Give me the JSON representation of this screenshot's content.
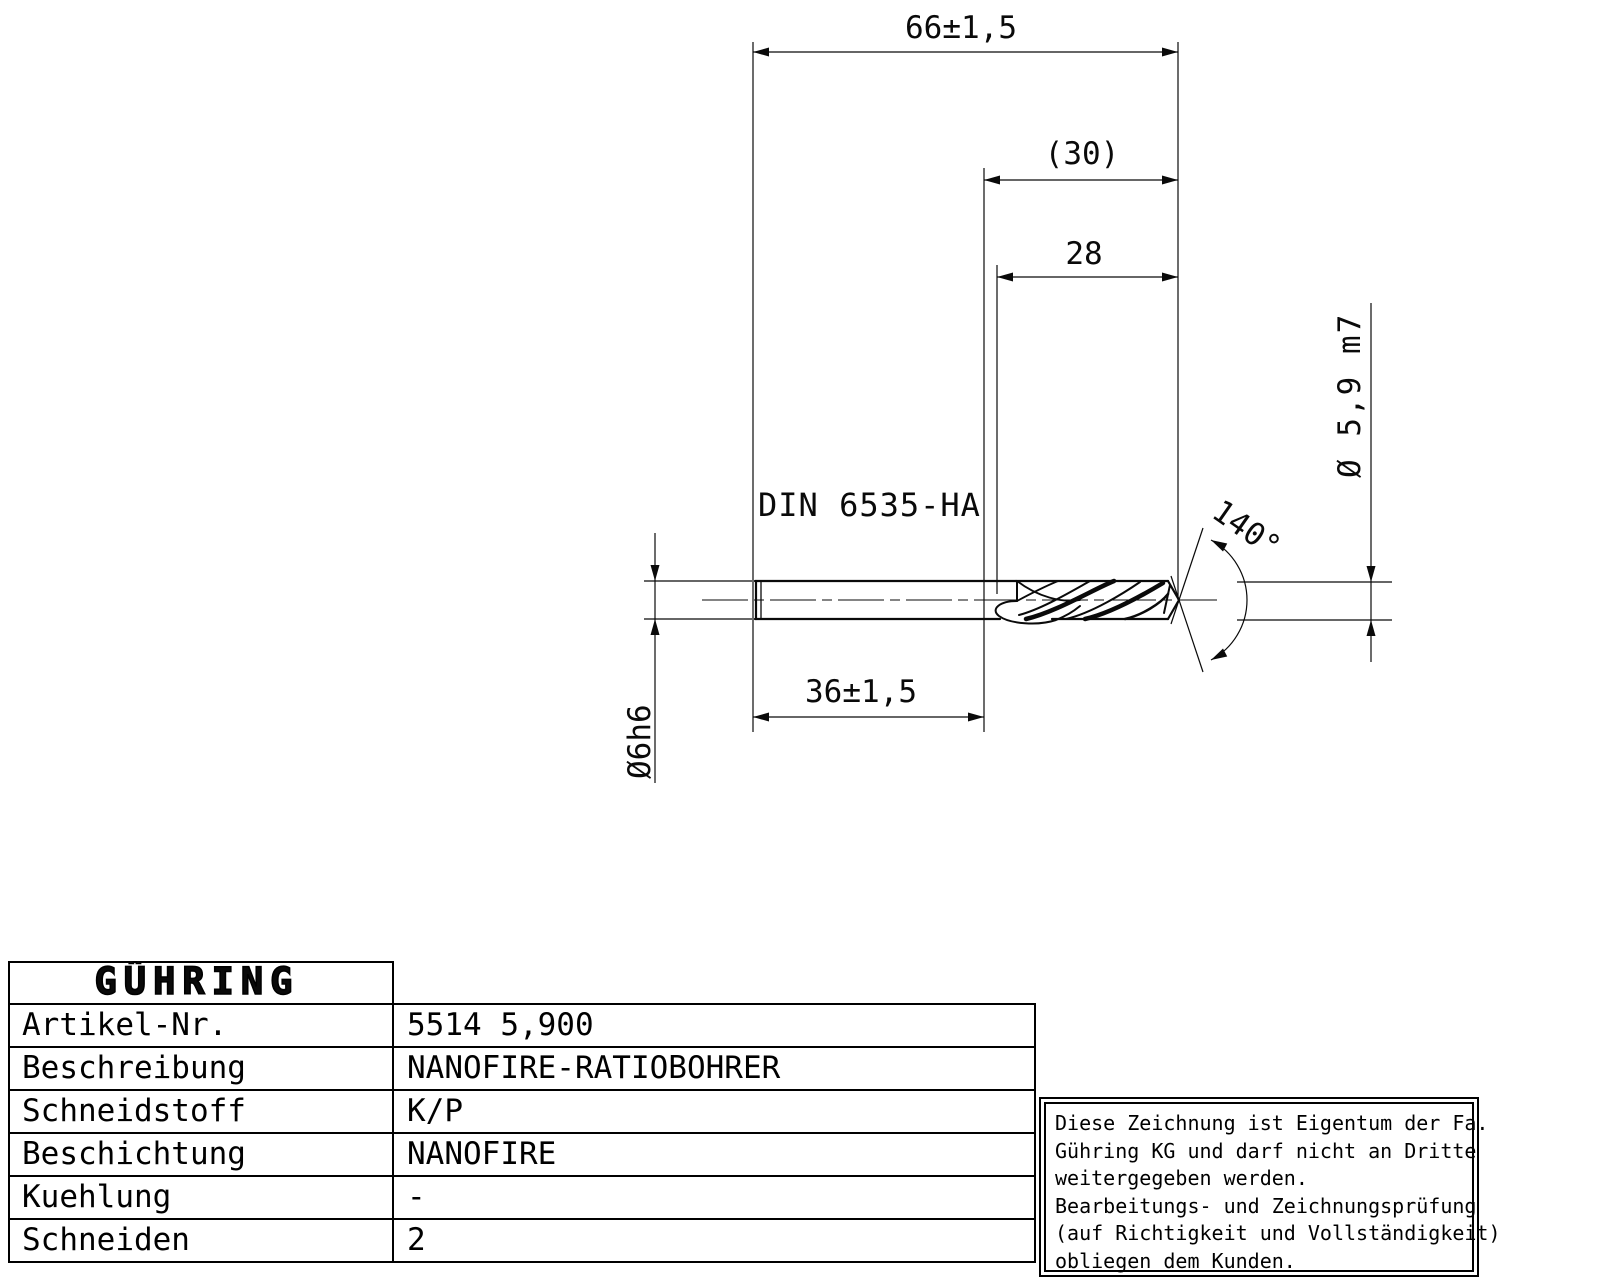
{
  "drawing": {
    "dim_overall_length": "66±1,5",
    "dim_reference": "(30)",
    "dim_flute_length": "28",
    "standard": "DIN 6535-HA",
    "dim_shank_length": "36±1,5",
    "dim_shank_diameter": "Ø6h6",
    "dim_cutting_diameter": "Ø 5,9 m7",
    "dim_point_angle": "140°"
  },
  "table": {
    "brand": "GÜHRING",
    "rows": [
      {
        "label": "Artikel-Nr.",
        "value": "5514 5,900"
      },
      {
        "label": "Beschreibung",
        "value": "NANOFIRE-RATIOBOHRER"
      },
      {
        "label": "Schneidstoff",
        "value": "K/P"
      },
      {
        "label": "Beschichtung",
        "value": "NANOFIRE"
      },
      {
        "label": "Kuehlung",
        "value": "-"
      },
      {
        "label": "Schneiden",
        "value": "2"
      }
    ]
  },
  "disclaimer": {
    "lines": [
      "Diese Zeichnung ist Eigentum der Fa.",
      "Gühring KG und darf nicht an Dritte",
      "weitergegeben werden.",
      "Bearbeitungs- und Zeichnungsprüfung",
      "(auf Richtigkeit und Vollständigkeit)",
      "obliegen dem Kunden."
    ]
  },
  "colors": {
    "line": "#000000",
    "background": "#ffffff"
  }
}
